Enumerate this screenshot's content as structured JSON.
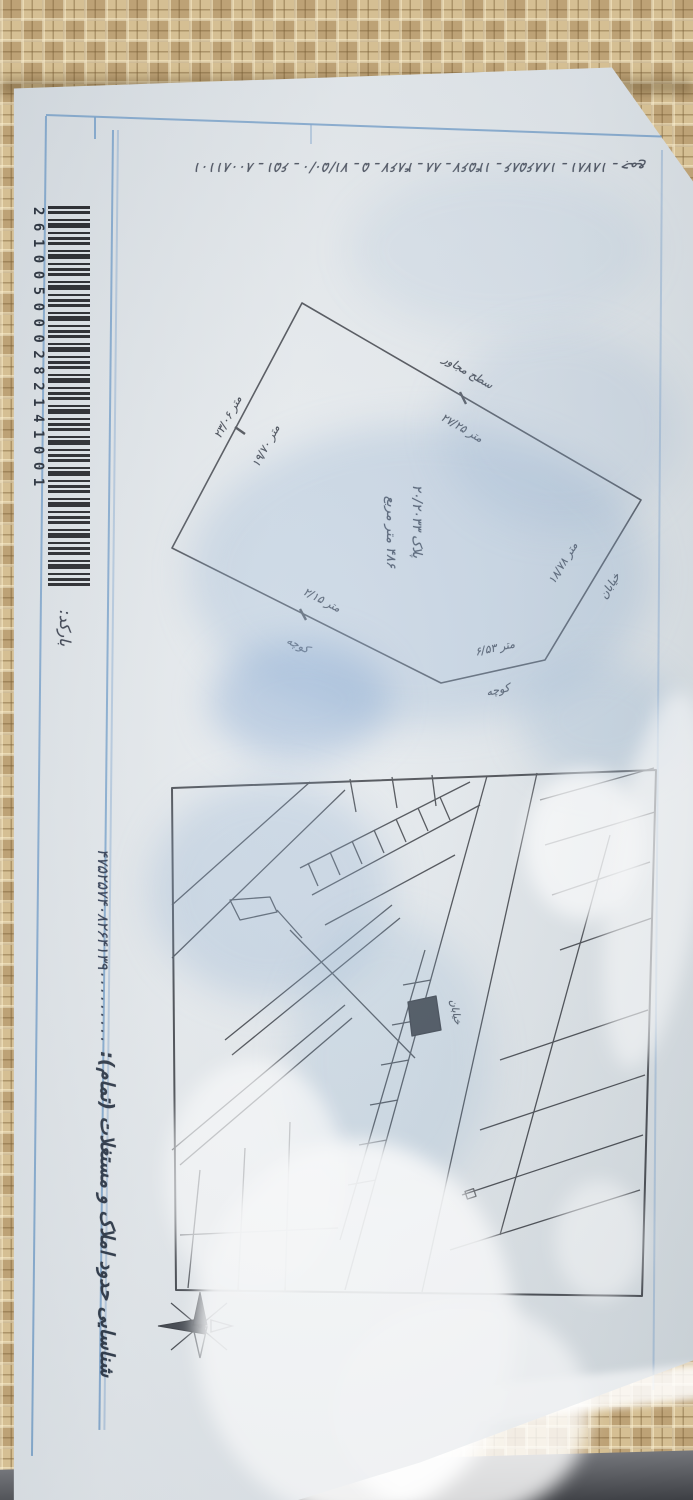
{
  "palette": {
    "wallpaper": "#c9b185",
    "paper": "#e3e8ec",
    "frame_blue": "#6e9bc8",
    "ink": "#2b3140",
    "map_line": "#3b3e44"
  },
  "doc": {
    "top_annotation": "۸۰۰۸۱۱۰۱ ـ ۶۵۱ ـ ۷۱/۵۰/۰ ـ ۵ ـ ۴۸۶۷ ـ ۸۸ ـ ۱۴۵۶۷ ـ ۱۸۸۶۵۸۶ ـ ۱۸۷۸۱ ـ جمع",
    "barcode": {
      "label": "بارکد:",
      "digits": "261005000282141001"
    },
    "margin": {
      "serial_number": "۴۷۵۲۵۷۴۰۸۲۶۴۱۳۹۰۰۰۰۰۰۰۰۰",
      "title": "شناسایی حدود املاک و مستغلات (تمام):"
    },
    "sketch": {
      "plot_no": "پلاک ۲۰/۲۰۳۳",
      "area": "۴۸۶ متر مربع",
      "edge_top_right": {
        "outside": "سطح مجاور",
        "inside": "متر ۲۷/۲۵"
      },
      "edge_right": {
        "outside": "خیابان",
        "inside": "متر ۱۸/۷۸"
      },
      "edge_bottom_right": {
        "outside": "کوچه",
        "inside": "متر ۶/۵۳"
      },
      "edge_bottom_left": {
        "outside": "کوچه",
        "inside": "متر ۲/۱۵"
      },
      "edge_top_left": {
        "outside": "متر ۲۳/۰۶",
        "inside": "متر ۱۹/۷۰"
      }
    },
    "map": {
      "street_label": "خیابان"
    }
  }
}
